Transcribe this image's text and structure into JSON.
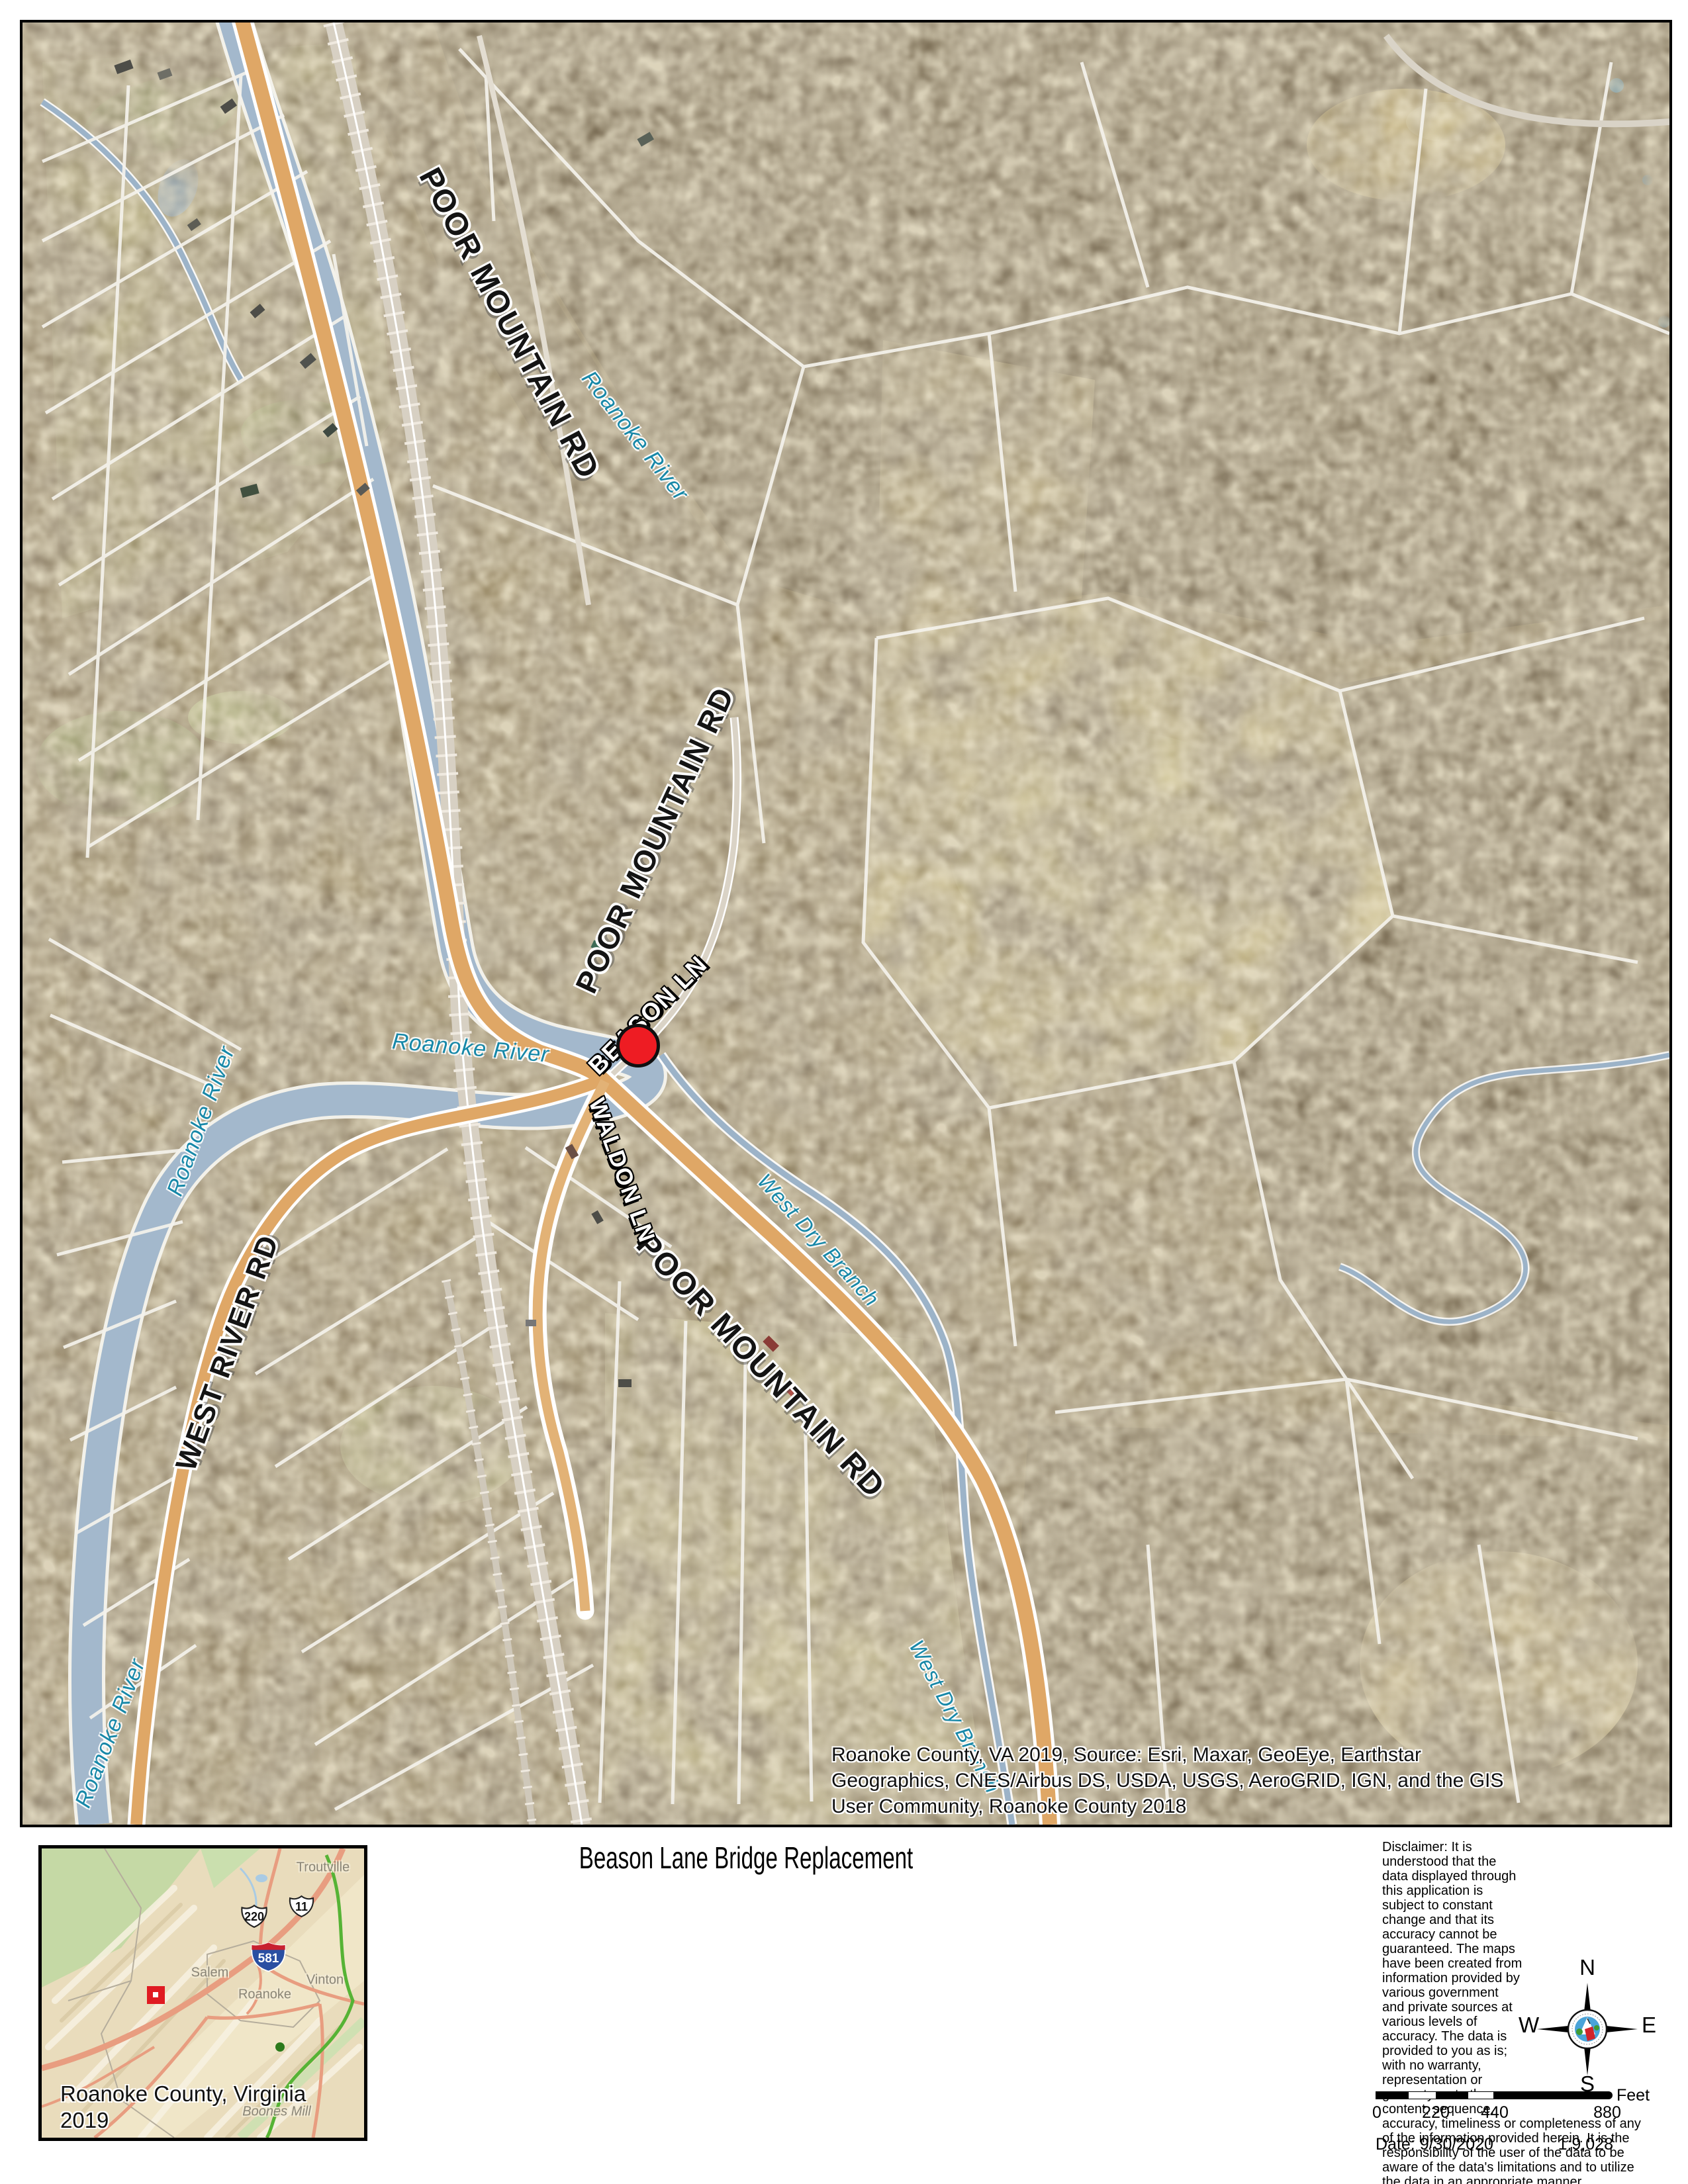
{
  "map": {
    "road_labels": {
      "poor_mountain_rd": "POOR MOUNTAIN RD",
      "west_river_rd": "WEST RIVER RD",
      "waldon_ln": "WALDON LN",
      "beason_ln": "BEASON LN"
    },
    "water_labels": {
      "roanoke_river": "Roanoke River",
      "west_dry_branch": "West Dry Branch"
    },
    "attribution": {
      "line1": "Roanoke County, VA 2019, Source: Esri, Maxar, GeoEye, Earthstar",
      "line2": "Geographics, CNES/Airbus DS, USDA, USGS, AeroGRID, IGN, and the GIS",
      "line3": "User Community, Roanoke County 2018"
    },
    "colors": {
      "marker_red": "#ee1c23",
      "river_blue": "#a3b8cc",
      "road_orange": "#dfa766",
      "water_label_teal": "#1788a8"
    }
  },
  "footer": {
    "title": "Beason Lane Bridge Replacement",
    "inset": {
      "place_labels": [
        "Troutville",
        "Salem",
        "Roanoke",
        "Vinton",
        "Boones Mill"
      ],
      "shields": {
        "us_220": "220",
        "us_11": "11",
        "i_581": "581"
      },
      "caption_line1": "Roanoke County, Virginia",
      "caption_line2": "2019",
      "colors": {
        "interstate_blue": "#2a4fa2",
        "interstate_red": "#c8202f"
      }
    },
    "disclaimer": "Disclaimer: It is understood that the data displayed through this application is subject to constant change and that its accuracy cannot be guaranteed. The maps have been created from information provided by various government and private sources at various levels of accuracy. The data is provided to you as is; with no warranty, representation or guaranty as to the content, sequence, accuracy, timeliness or completeness of any of the information provided herein. It is the responsibility of the user of the data to be aware of the data's limitations and to utilize the data in an appropriate manner.",
    "compass": {
      "north": "N",
      "south": "S",
      "east": "E",
      "west": "W"
    },
    "scale_bar": {
      "ticks": [
        "0",
        "220",
        "440",
        "880"
      ],
      "unit": "Feet"
    },
    "date_label": "Date: 9/30/2020",
    "scale_ratio": "1:9,028"
  }
}
